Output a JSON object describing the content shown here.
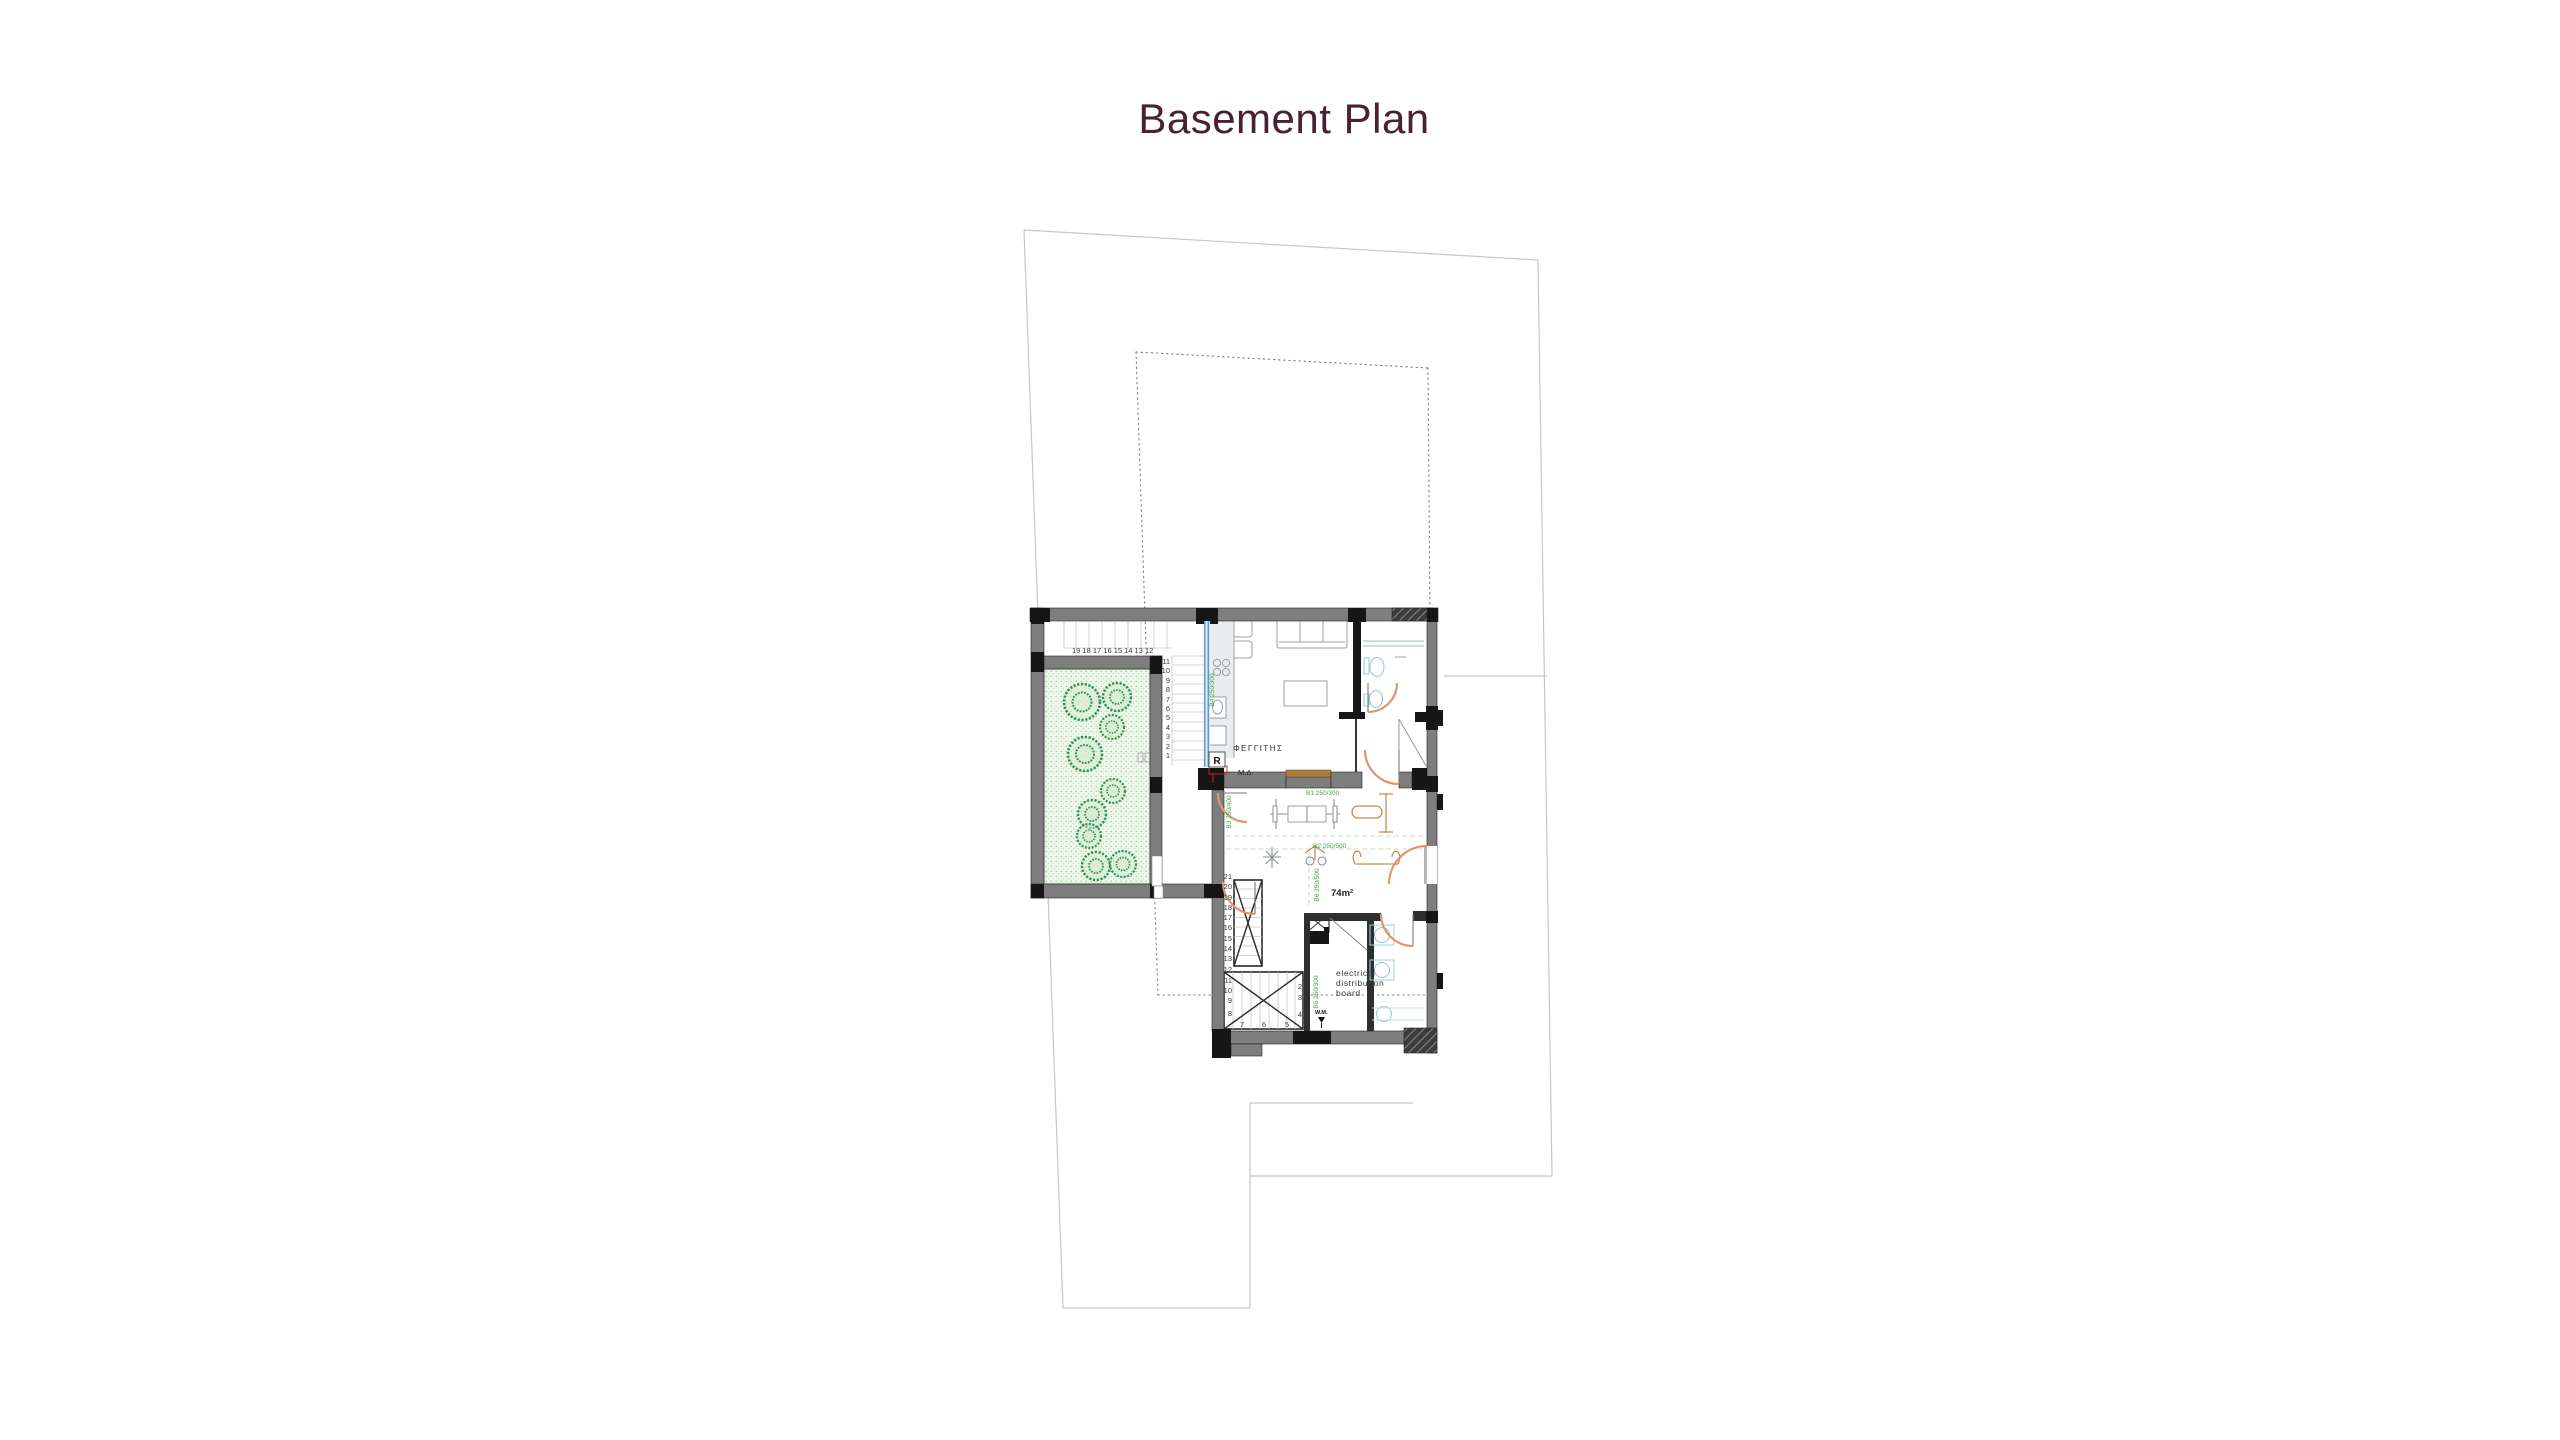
{
  "title": "Basement Plan",
  "plan": {
    "labels": {
      "skylight": "ΦΕΓΓΙΤΗΣ",
      "r_marker": "R",
      "md_marker": "Μ.Δ.",
      "area": "74m²",
      "electrical": [
        "electrical",
        "distribution",
        "board"
      ],
      "wm": "W.M."
    },
    "dims": {
      "window": "Β4 250/300",
      "b1": "Β1 250/300",
      "b2": "Β2 250/500",
      "b3": "Β3 250/400",
      "b5": "Β5 250/300",
      "b6": "Β6 250/500"
    },
    "stairs": {
      "top_run": "19 18 17 16 15 14 13 12",
      "right_column": [
        "11",
        "10",
        "9",
        "8",
        "7",
        "6",
        "5",
        "4",
        "3",
        "2",
        "1"
      ],
      "mid_column": [
        "21",
        "20",
        "19",
        "18",
        "17",
        "16",
        "15",
        "14",
        "13",
        "12"
      ],
      "lower_left": [
        "11",
        "10",
        "9",
        "8"
      ],
      "bottom_row": [
        "7",
        "6",
        "5"
      ],
      "lower_right": [
        "2",
        "3",
        "4"
      ]
    },
    "colors": {
      "title_text": "#4a2133",
      "wall_gray": "#7e7e7e",
      "wall_black": "#161616",
      "door_orange": "#e0956f",
      "dim_green": "#3fa93f",
      "dash_green": "#bfe3ba",
      "window_blue": "#5d9ad1",
      "tree_green": "#2e9150",
      "garden_bg": "#eef7ec",
      "fixture_teal": "#8fc7cc",
      "lintel_brown": "#a97c3f",
      "marker_red": "#cc2b20",
      "site_line": "#c6c6c6"
    }
  }
}
